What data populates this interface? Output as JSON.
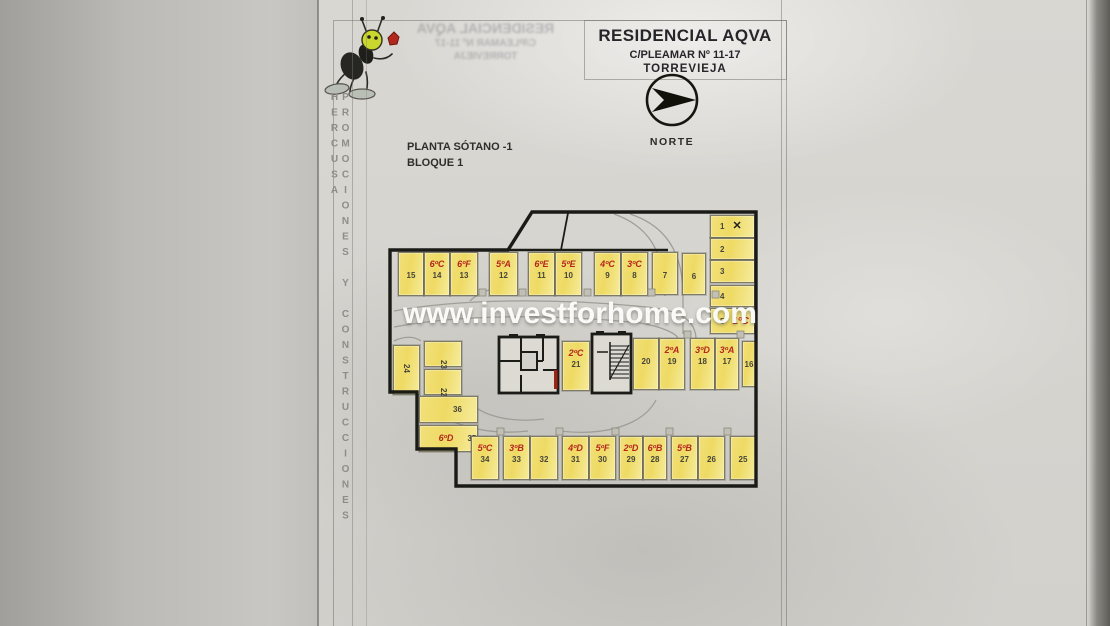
{
  "page": {
    "watermark": "www.investforhome.com",
    "side_text": "PROMOCIONES Y CONSTRUCCIONES HERCUSA"
  },
  "title_block": {
    "title": "RESIDENCIAL AQVA",
    "address": "C/PLEAMAR Nº 11-17",
    "city": "TORREVIEJA"
  },
  "compass": {
    "label": "NORTE"
  },
  "plan": {
    "floor_label": "PLANTA SÓTANO -1",
    "block_label": "BLOQUE 1",
    "colors": {
      "stall_fill": "#eeda63",
      "unit_label": "#b5271f",
      "outline": "#1a1a16",
      "watermark": "#fdfdfb"
    },
    "stalls": [
      {
        "n": 15,
        "x": 398,
        "y": 252,
        "w": 26,
        "h": 44
      },
      {
        "n": 14,
        "x": 424,
        "y": 252,
        "w": 26,
        "h": 44,
        "unit": "6ºC"
      },
      {
        "n": 13,
        "x": 450,
        "y": 252,
        "w": 28,
        "h": 44,
        "unit": "6ºF"
      },
      {
        "n": 12,
        "x": 489,
        "y": 252,
        "w": 29,
        "h": 44,
        "unit": "5ºA"
      },
      {
        "n": 11,
        "x": 528,
        "y": 252,
        "w": 27,
        "h": 44,
        "unit": "6ºE"
      },
      {
        "n": 10,
        "x": 555,
        "y": 252,
        "w": 27,
        "h": 44,
        "unit": "5ºE"
      },
      {
        "n": 9,
        "x": 594,
        "y": 252,
        "w": 27,
        "h": 44,
        "unit": "4ºC"
      },
      {
        "n": 8,
        "x": 621,
        "y": 252,
        "w": 27,
        "h": 44,
        "unit": "3ºC"
      },
      {
        "n": 7,
        "x": 652,
        "y": 252,
        "w": 26,
        "h": 43
      },
      {
        "n": 6,
        "x": 682,
        "y": 253,
        "w": 24,
        "h": 42
      },
      {
        "n": 1,
        "x": 710,
        "y": 215,
        "w": 45,
        "h": 23,
        "kind": "side",
        "xmark": true
      },
      {
        "n": 2,
        "x": 710,
        "y": 238,
        "w": 45,
        "h": 22,
        "kind": "side"
      },
      {
        "n": 3,
        "x": 710,
        "y": 260,
        "w": 45,
        "h": 23,
        "kind": "side"
      },
      {
        "n": 4,
        "x": 710,
        "y": 285,
        "w": 45,
        "h": 22,
        "kind": "side"
      },
      {
        "n": 5,
        "x": 710,
        "y": 308,
        "w": 45,
        "h": 26,
        "kind": "side",
        "unit": "1ºC"
      },
      {
        "n": 24,
        "x": 393,
        "y": 345,
        "w": 27,
        "h": 50,
        "rot": true
      },
      {
        "n": 23,
        "x": 424,
        "y": 341,
        "w": 38,
        "h": 26,
        "rot": true
      },
      {
        "n": 22,
        "x": 424,
        "y": 369,
        "w": 38,
        "h": 26,
        "rot": true
      },
      {
        "n": 21,
        "x": 562,
        "y": 341,
        "w": 28,
        "h": 50,
        "unit": "2ºC"
      },
      {
        "n": 20,
        "x": 633,
        "y": 338,
        "w": 26,
        "h": 52
      },
      {
        "n": 19,
        "x": 659,
        "y": 338,
        "w": 26,
        "h": 52,
        "unit": "2ºA"
      },
      {
        "n": 18,
        "x": 690,
        "y": 338,
        "w": 25,
        "h": 52,
        "unit": "3ºD"
      },
      {
        "n": 17,
        "x": 715,
        "y": 338,
        "w": 24,
        "h": 52,
        "unit": "3ºA"
      },
      {
        "n": 16,
        "x": 742,
        "y": 341,
        "w": 14,
        "h": 46
      },
      {
        "n": 36,
        "x": 419,
        "y": 396,
        "w": 59,
        "h": 27,
        "kind": "wide"
      },
      {
        "n": 35,
        "x": 419,
        "y": 425,
        "w": 59,
        "h": 27,
        "kind": "wide",
        "unit": "6ºD"
      },
      {
        "n": 34,
        "x": 471,
        "y": 436,
        "w": 28,
        "h": 44,
        "unit": "5ºC"
      },
      {
        "n": 33,
        "x": 503,
        "y": 436,
        "w": 27,
        "h": 44,
        "unit": "3ºB"
      },
      {
        "n": 32,
        "x": 530,
        "y": 436,
        "w": 28,
        "h": 44
      },
      {
        "n": 31,
        "x": 562,
        "y": 436,
        "w": 27,
        "h": 44,
        "unit": "4ºD"
      },
      {
        "n": 30,
        "x": 589,
        "y": 436,
        "w": 27,
        "h": 44,
        "unit": "5ºF"
      },
      {
        "n": 29,
        "x": 619,
        "y": 436,
        "w": 24,
        "h": 44,
        "unit": "2ºD"
      },
      {
        "n": 28,
        "x": 643,
        "y": 436,
        "w": 24,
        "h": 44,
        "unit": "6ºB"
      },
      {
        "n": 27,
        "x": 671,
        "y": 436,
        "w": 27,
        "h": 44,
        "unit": "5ºB"
      },
      {
        "n": 26,
        "x": 698,
        "y": 436,
        "w": 27,
        "h": 44
      },
      {
        "n": 25,
        "x": 730,
        "y": 436,
        "w": 26,
        "h": 44
      }
    ]
  }
}
